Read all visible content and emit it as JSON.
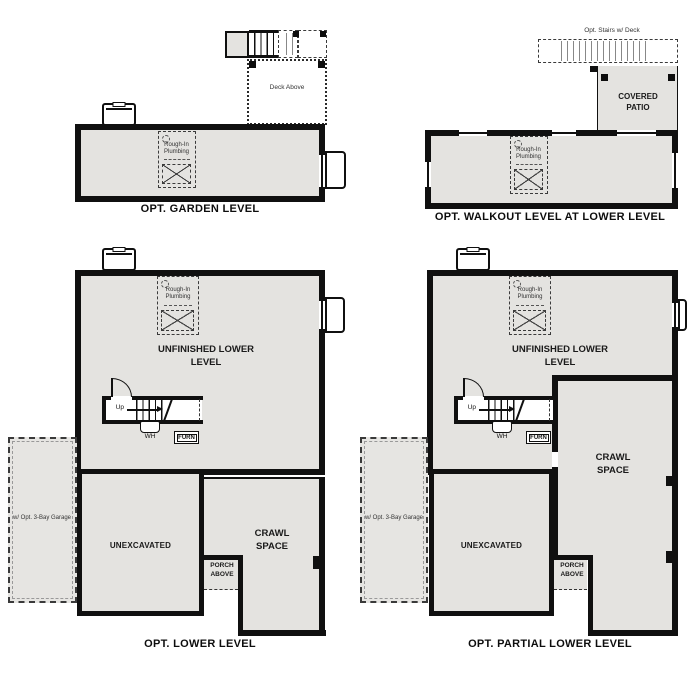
{
  "document": {
    "type": "floor-plan-options-sheet"
  },
  "colors": {
    "wall": "#101010",
    "room_fill": "#e4e3e0",
    "background": "#ffffff"
  },
  "plans": [
    {
      "title": "OPT. GARDEN LEVEL",
      "labels": {
        "deck": "Deck Above",
        "rough_in": "Rough-In Plumbing"
      }
    },
    {
      "title": "OPT. WALKOUT LEVEL AT LOWER LEVEL",
      "labels": {
        "stairs": "Opt. Stairs w/ Deck",
        "patio": "COVERED PATIO",
        "rough_in": "Rough-In Plumbing"
      }
    },
    {
      "title": "OPT. LOWER LEVEL",
      "labels": {
        "room": "UNFINISHED LOWER LEVEL",
        "rough_in": "Rough-In Plumbing",
        "up": "Up",
        "wh": "WH",
        "furn": "FURN",
        "unexcavated": "UNEXCAVATED",
        "crawl": "CRAWL SPACE",
        "porch": "PORCH ABOVE",
        "garage": "w/ Opt. 3-Bay Garage"
      }
    },
    {
      "title": "OPT. PARTIAL LOWER LEVEL",
      "labels": {
        "room": "UNFINISHED LOWER LEVEL",
        "rough_in": "Rough-In Plumbing",
        "up": "Up",
        "wh": "WH",
        "furn": "FURN",
        "unexcavated": "UNEXCAVATED",
        "crawl": "CRAWL SPACE",
        "porch": "PORCH ABOVE",
        "garage": "w/ Opt. 3-Bay Garage"
      }
    }
  ]
}
